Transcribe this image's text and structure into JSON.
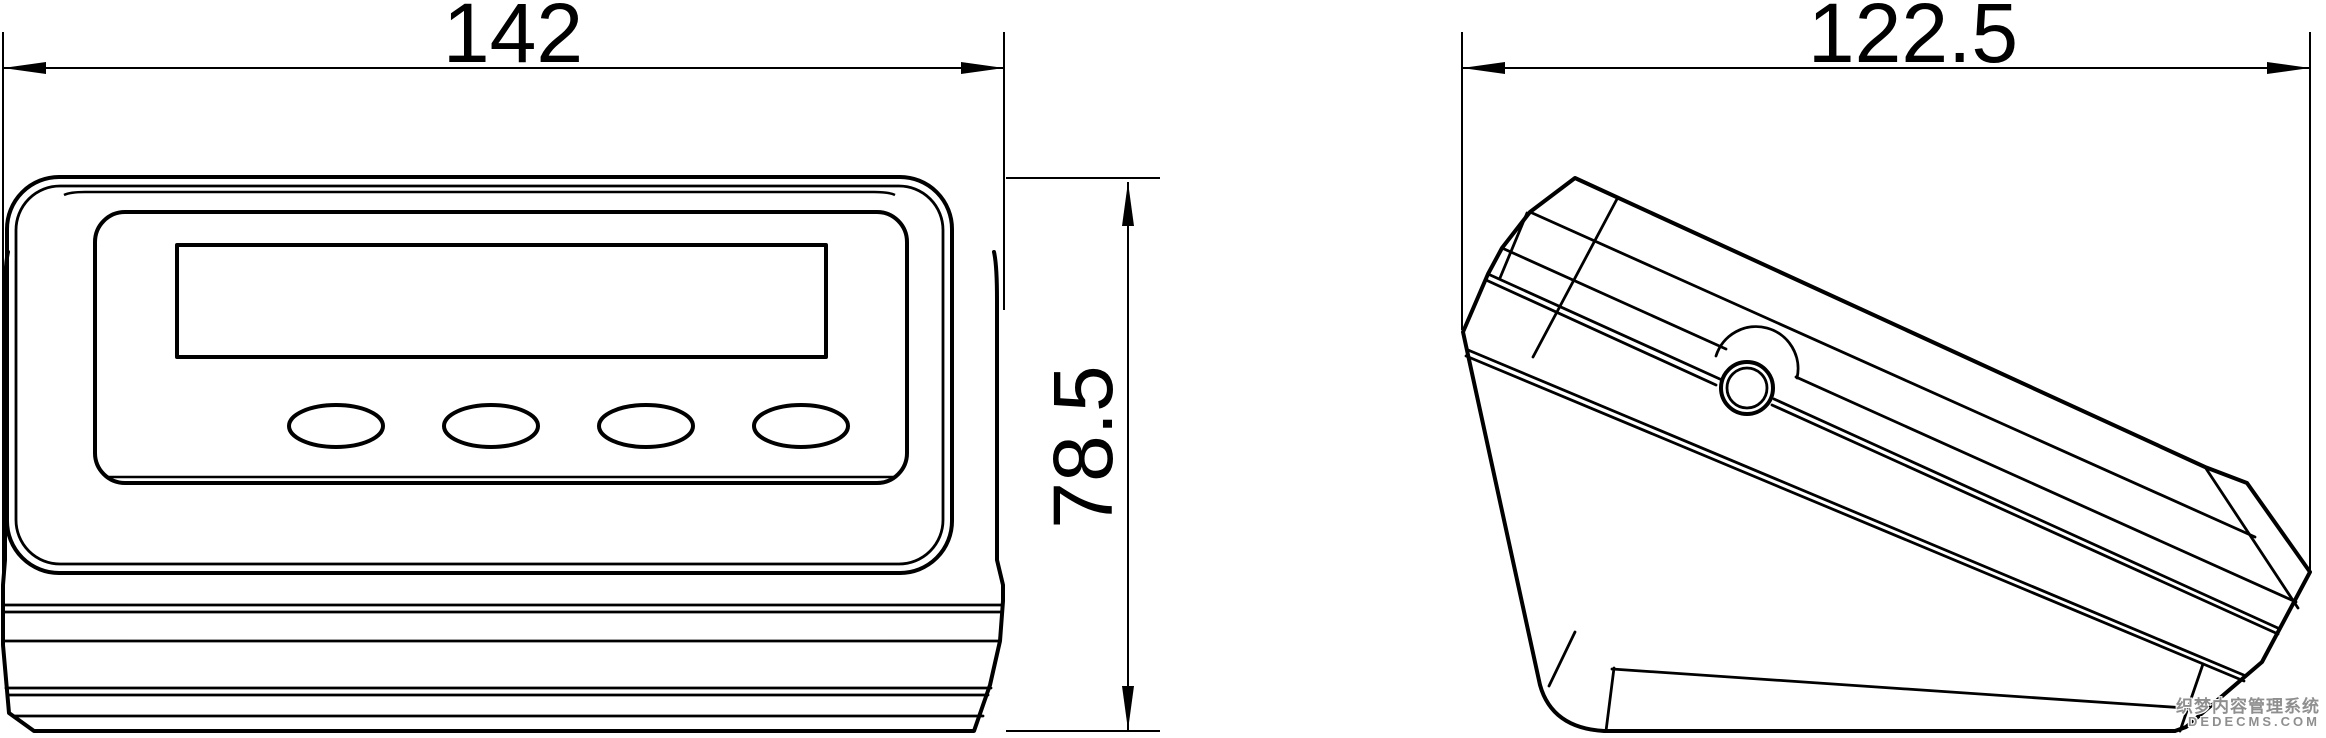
{
  "drawing_type": "dimensioned outline drawing of weighing indicator (front view and side view)",
  "dimensions": {
    "front_width": "142",
    "front_height": "78.5",
    "side_width": "122.5"
  },
  "views": {
    "front": {
      "features": [
        "display-window",
        "button-row-of-4-oval-buttons",
        "stacked-case-seam-lines"
      ]
    },
    "side": {
      "features": [
        "sloped-wedge-profile",
        "mounting-knob",
        "case-seam-double-line"
      ]
    }
  },
  "watermark": {
    "line1": "织梦内容管理系统",
    "line2": "DEDECMS.COM"
  },
  "colors": {
    "ink": "#000000",
    "background": "#ffffff",
    "watermark_gray": "#8f8f8f"
  }
}
